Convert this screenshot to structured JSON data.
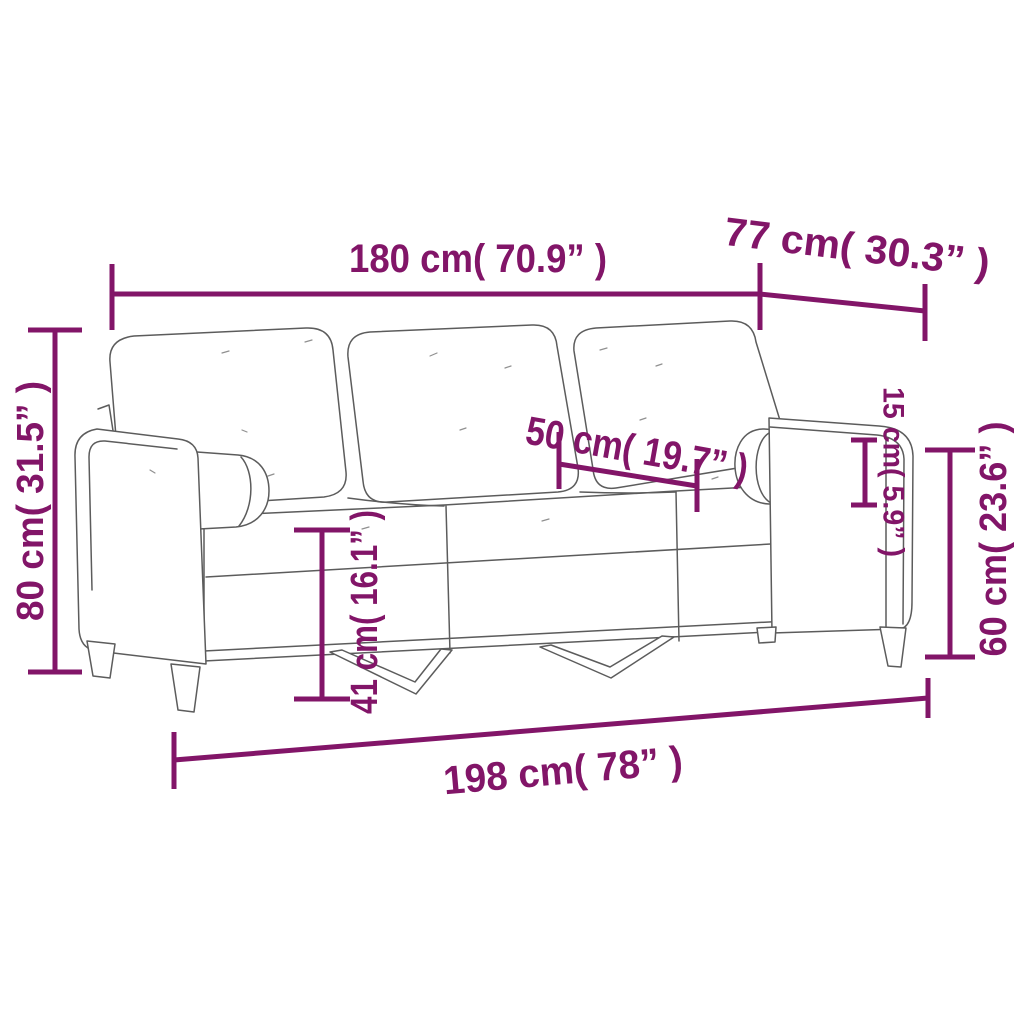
{
  "diagram": {
    "subject": "three-seater-sofa-with-bolster-cushions",
    "colors": {
      "dimension_accent": "#821568",
      "outline_gray": "#5c5c5c",
      "background": "#ffffff"
    },
    "dimensions": [
      {
        "id": "sofa-width",
        "label": "180 cm( 70.9” )",
        "cm": 180,
        "inches": 70.9,
        "orientation": "horizontal"
      },
      {
        "id": "sofa-depth",
        "label": "77 cm( 30.3” )",
        "cm": 77,
        "inches": 30.3,
        "orientation": "diagonal"
      },
      {
        "id": "back-height",
        "label": "80 cm( 31.5” )",
        "cm": 80,
        "inches": 31.5,
        "orientation": "vertical"
      },
      {
        "id": "seat-depth",
        "label": "50 cm( 19.7” )",
        "cm": 50,
        "inches": 19.7,
        "orientation": "diagonal"
      },
      {
        "id": "bolster-height",
        "label": "15 cm( 5.9” )",
        "cm": 15,
        "inches": 5.9,
        "orientation": "vertical"
      },
      {
        "id": "arm-height",
        "label": "60 cm( 23.6” )",
        "cm": 60,
        "inches": 23.6,
        "orientation": "vertical"
      },
      {
        "id": "seat-height",
        "label": "41 cm( 16.1” )",
        "cm": 41,
        "inches": 16.1,
        "orientation": "vertical"
      },
      {
        "id": "total-width",
        "label": "198 cm( 78” )",
        "cm": 198,
        "inches": 78,
        "orientation": "horizontal"
      }
    ]
  }
}
